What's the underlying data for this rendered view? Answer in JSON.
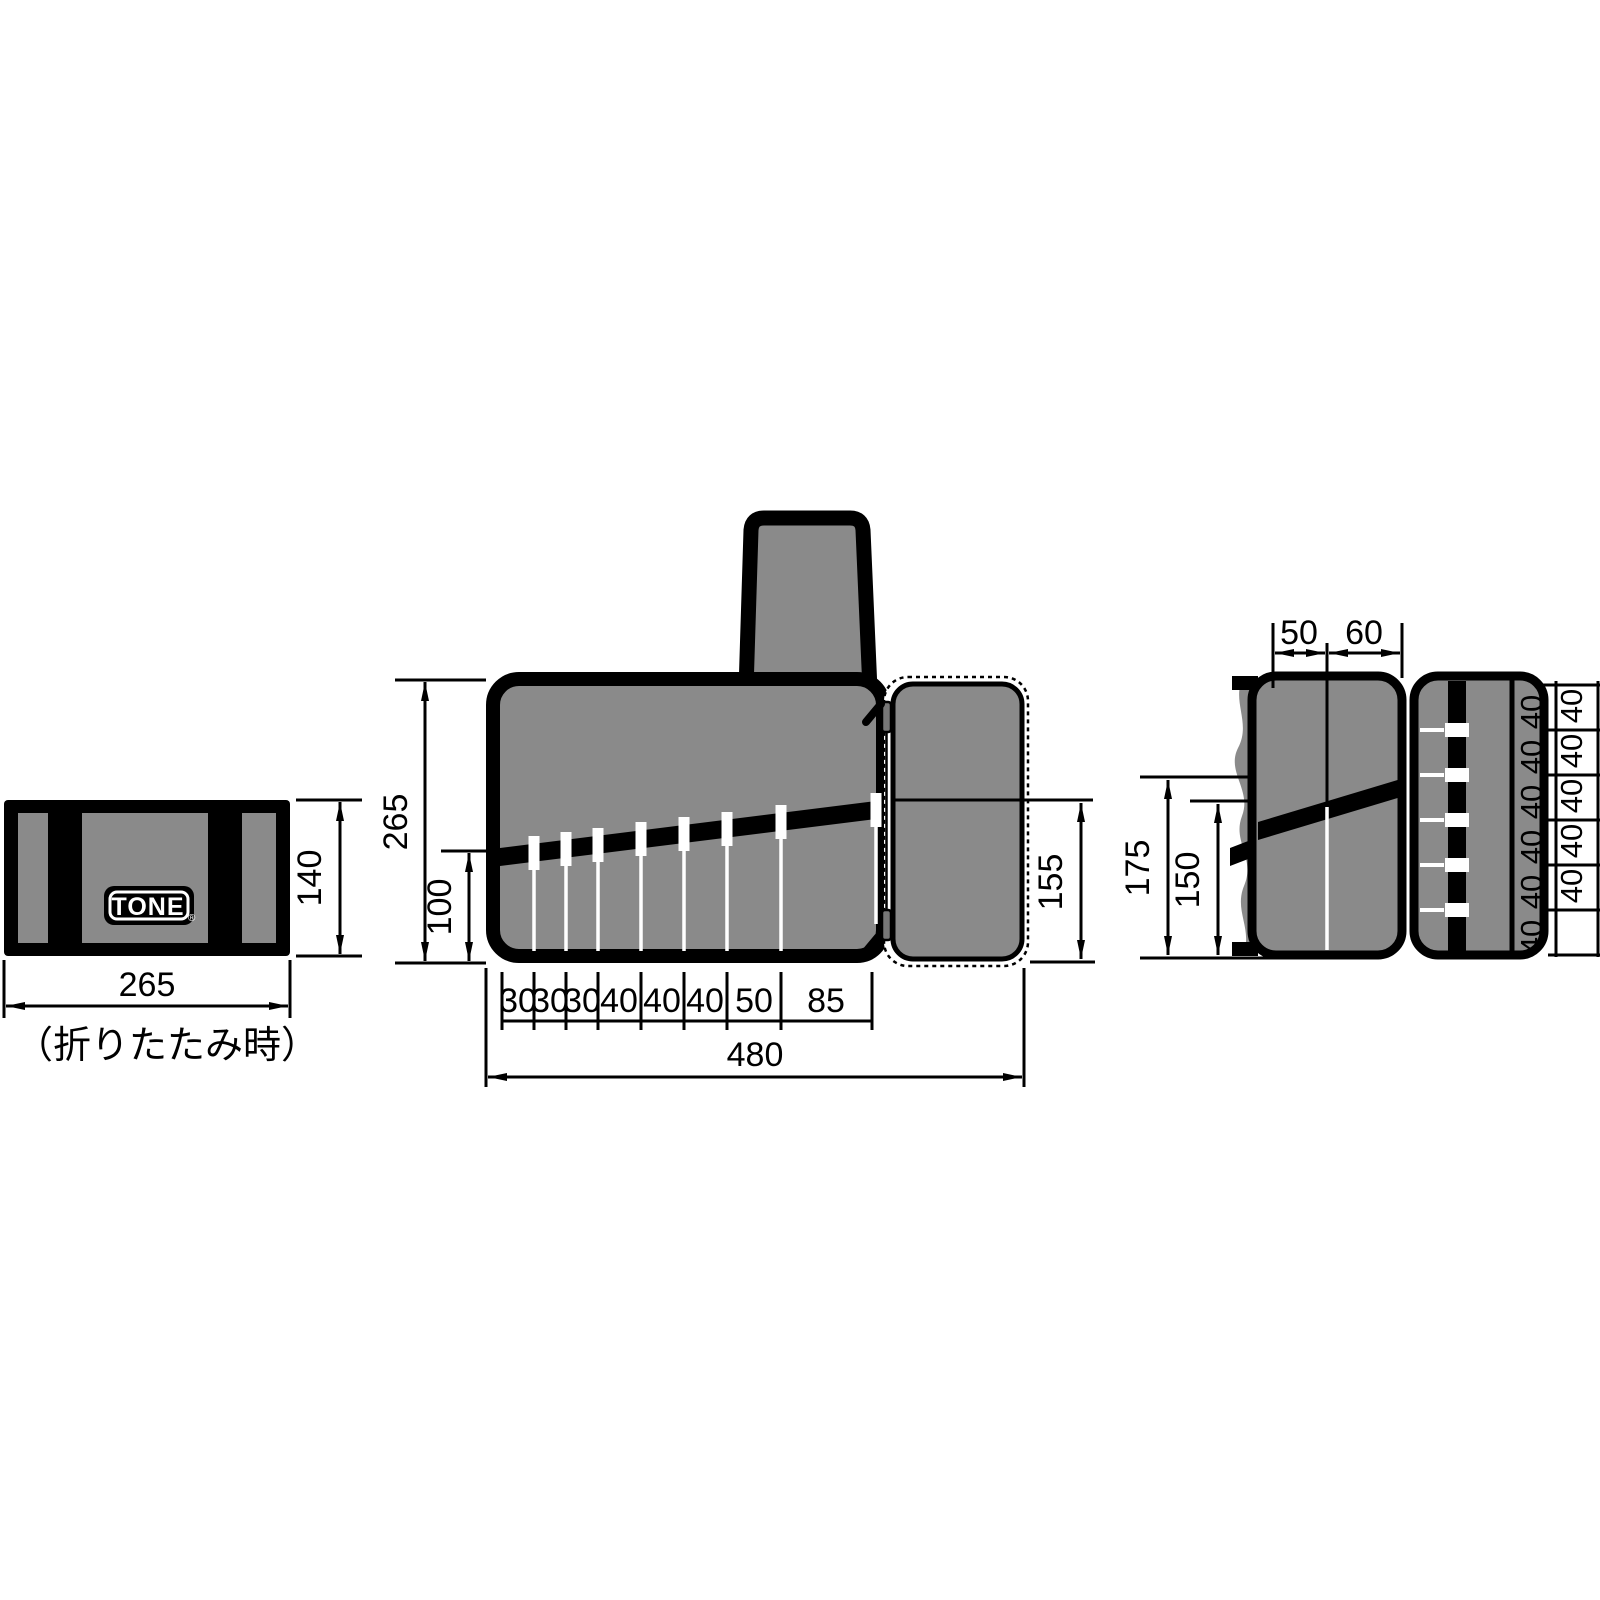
{
  "drawing": {
    "colors": {
      "body_gray": "#8a8a8a",
      "line_black": "#000000",
      "pocket_white": "#ffffff"
    },
    "folded_view": {
      "logo_text": "TONE",
      "registered_mark": "®",
      "width_label": "265",
      "height_label": "140",
      "caption": "（折りたたみ時）"
    },
    "front_view": {
      "height_label": "265",
      "pocket_depth_label": "100",
      "overall_width_label": "480",
      "flap_height_label": "155",
      "pocket_width_labels": [
        "30",
        "30",
        "30",
        "40",
        "40",
        "40",
        "50",
        "85"
      ]
    },
    "side_view": {
      "top_width_labels": [
        "50",
        "60"
      ],
      "height_labels": [
        "175",
        "150"
      ],
      "pitch_labels_inner": [
        "40",
        "40",
        "40",
        "40",
        "40",
        "40"
      ],
      "pitch_labels_outer": [
        "40",
        "40",
        "40",
        "40",
        "40"
      ]
    }
  }
}
